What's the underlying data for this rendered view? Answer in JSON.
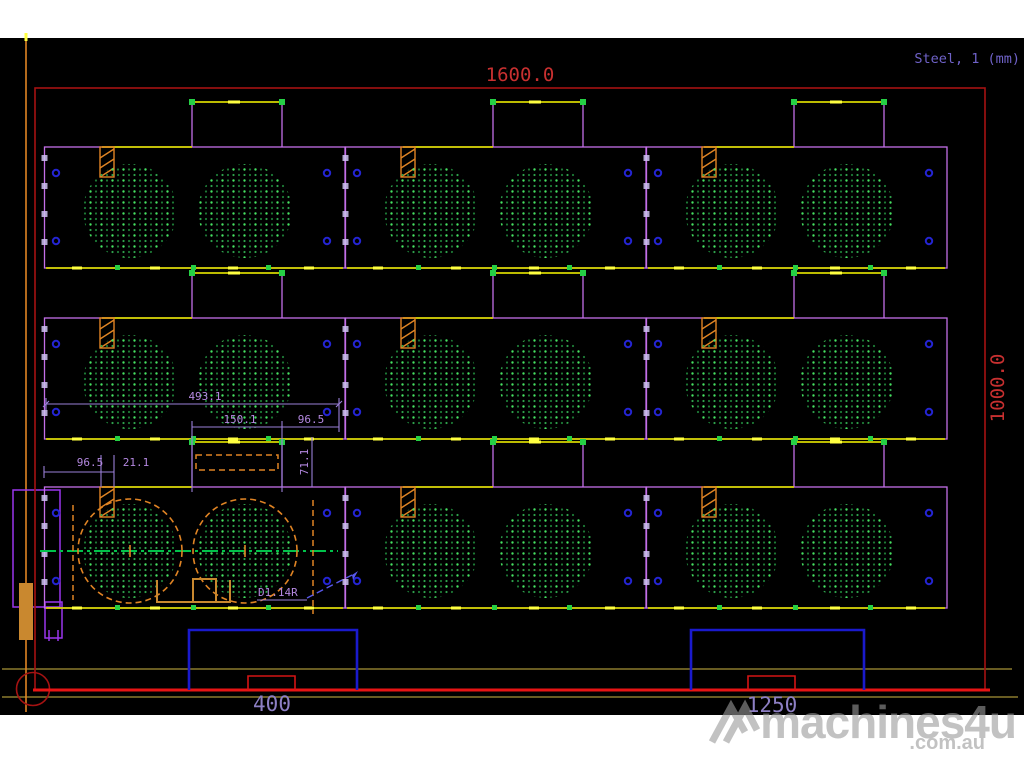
{
  "header": {
    "material_info": "Steel, 1 (mm)"
  },
  "sheet": {
    "width_dim": "1600.0",
    "height_dim": "1000.0"
  },
  "dims": {
    "part_width": "493.1",
    "tab_width": "150.1",
    "tab_offset": "96.5",
    "clamp_offset": "96.5",
    "clamp_width": "21.1",
    "tab_height": "71.1",
    "hole_label": "D1.14R"
  },
  "clamps": {
    "positions": [
      "400",
      "1250"
    ]
  },
  "watermark": {
    "brand": "machines4u",
    "tld": ".com.au"
  },
  "colors": {
    "page": "#ffffff",
    "background": "#000000",
    "sheet_border": "#a51212",
    "sheet_border_bright": "#e81414",
    "dim_red_text": "#c83030",
    "material_violet": "#6f62c8",
    "part_outline": "#c36fe8",
    "cut_yellow": "#d6d600",
    "cut_yellow_bright": "#ffff40",
    "tick_green": "#25d045",
    "dot_green_bright": "#46e262",
    "dot_green_dim": "#1d7a35",
    "dot_green_mid": "#2ea04b",
    "hole_blue": "#2424d2",
    "clamp_blue": "#1a1acc",
    "clamp_red": "#d41414",
    "label_violet": "#8d7fc4",
    "dim_purple": "#b488e0",
    "dim_line": "#9a7fd8",
    "orange": "#e08424",
    "orange_fill": "#c9882f",
    "olive": "#8a7a2e",
    "purple_bracket": "#9a35ee",
    "center_green": "#00c24a",
    "leader_blue": "#5858ea",
    "edge_tick": "#cfc2f2",
    "watermark_gray": "#9a9a9a"
  }
}
